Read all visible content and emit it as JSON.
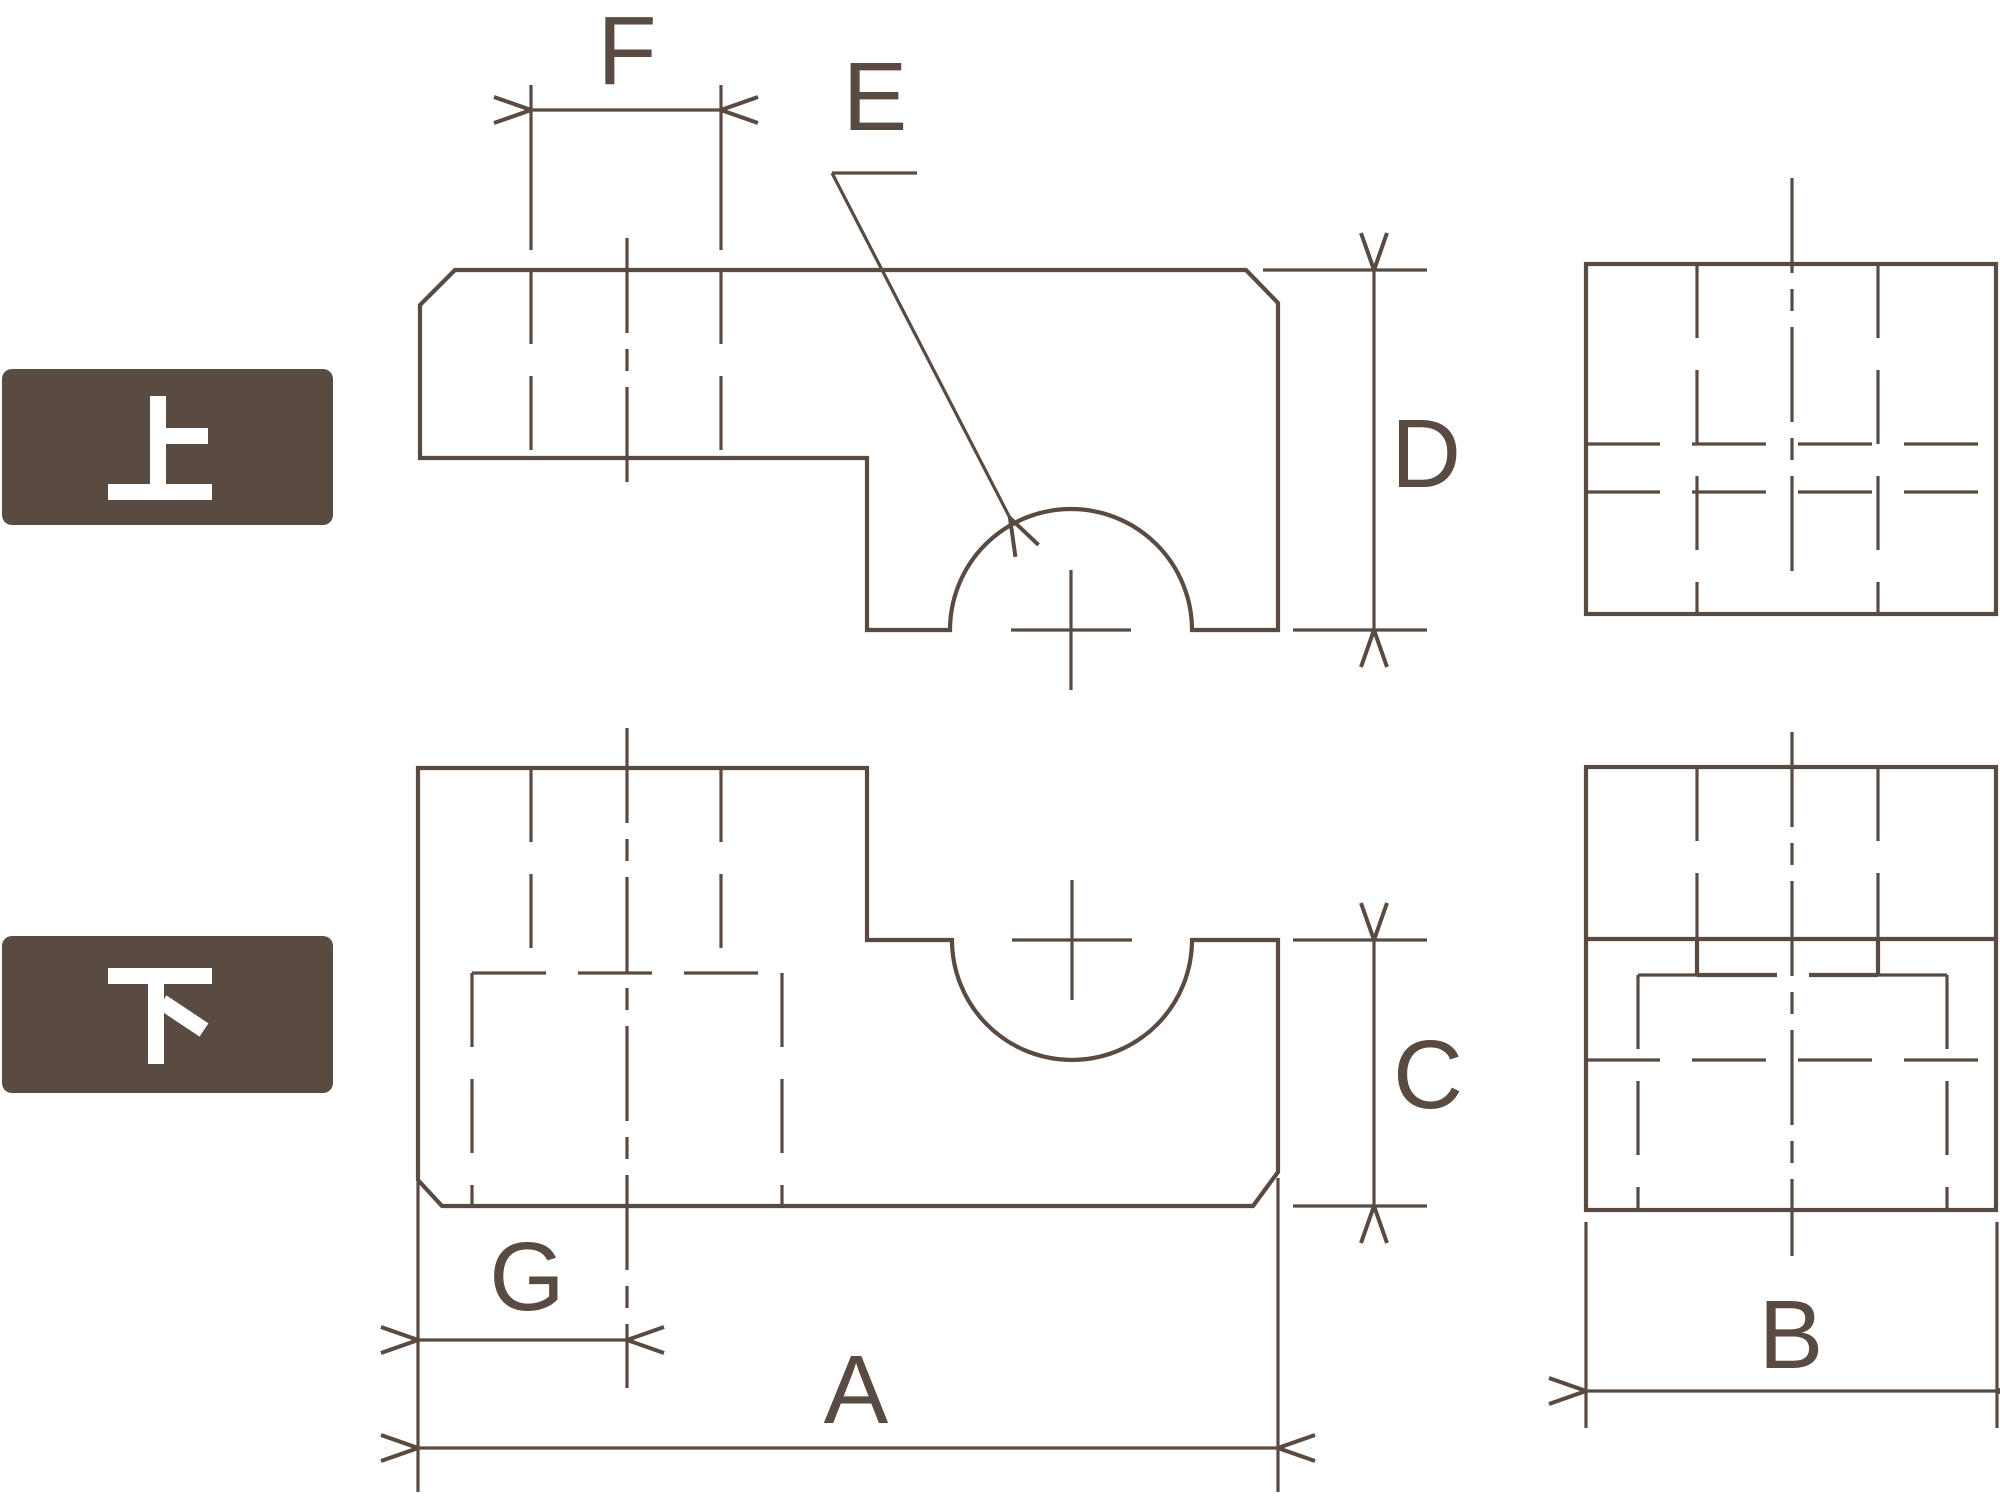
{
  "colors": {
    "ink": "#594a42",
    "background": "#ffffff",
    "badge_fill": "#594a42",
    "badge_text": "#ffffff"
  },
  "badges": {
    "upper": "上",
    "lower": "下"
  },
  "dimension_labels": {
    "A": "A",
    "B": "B",
    "C": "C",
    "D": "D",
    "E": "E",
    "F": "F",
    "G": "G"
  }
}
